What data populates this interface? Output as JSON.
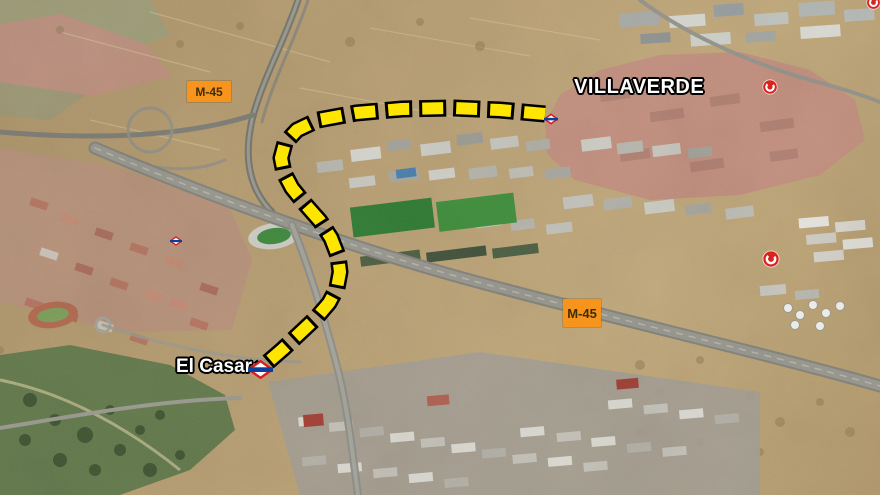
{
  "map": {
    "kind": "aerial-satellite-annotated",
    "labels": {
      "villaverde": "VILLAVERDE",
      "el_casar": "El Casar"
    },
    "road_badges": [
      {
        "text": "M-45",
        "color": "#f7941e",
        "position": "upper-left"
      },
      {
        "text": "M-45",
        "color": "#f7941e",
        "position": "lower-right"
      }
    ],
    "route": {
      "style": "dashed",
      "color": "#ffe600",
      "outline": "#000000",
      "from": "Villaverde (metro marker)",
      "to": "El Casar (metro marker)",
      "points": [
        [
          545,
          114
        ],
        [
          500,
          110
        ],
        [
          452,
          108
        ],
        [
          402,
          109
        ],
        [
          356,
          113
        ],
        [
          318,
          120
        ],
        [
          297,
          130
        ],
        [
          285,
          143
        ],
        [
          281,
          158
        ],
        [
          284,
          173
        ],
        [
          292,
          188
        ],
        [
          305,
          204
        ],
        [
          320,
          221
        ],
        [
          331,
          238
        ],
        [
          338,
          256
        ],
        [
          340,
          272
        ],
        [
          337,
          288
        ],
        [
          329,
          303
        ],
        [
          317,
          317
        ],
        [
          300,
          333
        ],
        [
          283,
          349
        ],
        [
          268,
          362
        ],
        [
          259,
          369
        ]
      ]
    },
    "icons": [
      {
        "name": "madrid-metro-logo",
        "at": "route-start-villaverde"
      },
      {
        "name": "madrid-metro-logo",
        "at": "railway-left"
      },
      {
        "name": "madrid-metro-logo",
        "at": "el-casar-station"
      },
      {
        "name": "cercanias-logo",
        "at": "villaverde-right"
      },
      {
        "name": "cercanias-logo",
        "at": "right-middle"
      },
      {
        "name": "cercanias-logo",
        "at": "top-right-corner-partial"
      }
    ],
    "colors": {
      "terrain_tan": "#b49a6e",
      "urban_pink": "#c4907f",
      "industrial_grey": "#b5b5ad",
      "sports_green": "#3f8f3b",
      "park_green": "#637a4b",
      "road_grey": "#8b8b83",
      "badge_orange": "#f7941e",
      "route_yellow": "#ffe600",
      "metro_red": "#d81e1e",
      "metro_blue": "#0a3f9e",
      "cercanias_red": "#d8231f"
    }
  }
}
